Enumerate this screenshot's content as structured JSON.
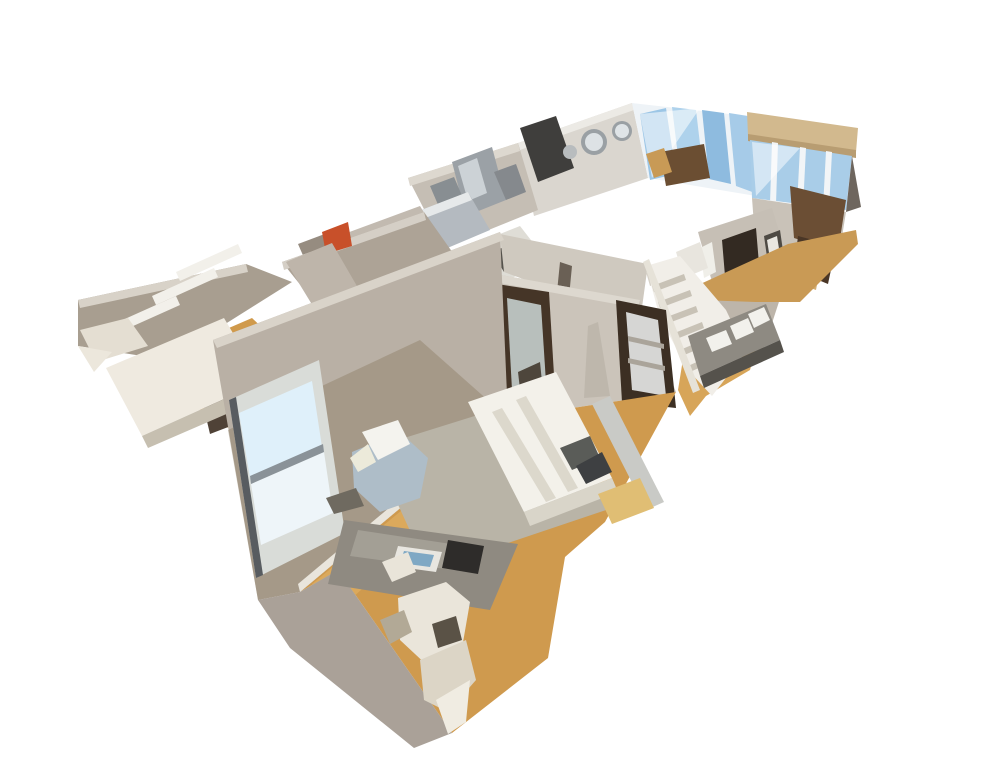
{
  "meta": {
    "description": "3D dollhouse cutaway view of an apartment interior scan, floating on a white background",
    "view": "dollhouse-orbit"
  },
  "canvas": {
    "width": 994,
    "height": 779,
    "background": "#ffffff"
  },
  "palette": {
    "wall_light": "#c8c1b6",
    "wall_mid": "#b9b0a5",
    "wall_dark": "#8f7f68",
    "wall_top_cut": "#ddd8cf",
    "floor_wood": "#cf9a4e",
    "floor_wood_light": "#dfae62",
    "rug": "#b9b4a7",
    "bed_white": "#f3f1ea",
    "window_blue": "#9cc6e6",
    "stainless": "#9ba1a6",
    "door_bronze": "#453527",
    "stair_white": "#f1eee8",
    "beam_tan": "#d2b98e",
    "accent_orange": "#c8502a"
  },
  "scene": {
    "shapes": [
      {
        "n": "far-wall-left",
        "f": "#dad6cf",
        "p": "518,143 632,103 648,178 534,216"
      },
      {
        "n": "far-wall-top-edge",
        "f": "#eceae5",
        "p": "518,143 632,103 634,110 520,150"
      },
      {
        "n": "far-window-frame",
        "f": "#eef3f7",
        "p": "632,103 747,116 756,196 648,178"
      },
      {
        "n": "far-window-pane-1",
        "f": "#9cc6e6",
        "p": "640,114 666,108 676,174 650,180"
      },
      {
        "n": "far-window-pane-2",
        "f": "#aed2ec",
        "p": "672,107 696,110 704,178 680,173"
      },
      {
        "n": "far-window-pane-3",
        "f": "#8ebbdf",
        "p": "702,110 724,113 731,184 709,179"
      },
      {
        "n": "far-window-pane-4",
        "f": "#a6cbe8",
        "p": "729,113 748,116 755,193 736,186"
      },
      {
        "n": "far-window-reflection",
        "f": "#ffffff",
        "o": 0.55,
        "p": "640,114 700,108 652,178"
      },
      {
        "n": "window-furniture-dark",
        "f": "#6b4e32",
        "p": "660,152 704,144 710,178 666,186"
      },
      {
        "n": "window-chair-tan",
        "f": "#c89a56",
        "p": "646,154 664,148 672,172 654,178"
      },
      {
        "n": "ceiling-beam",
        "f": "#d2b98e",
        "p": "747,112 858,128 856,152 748,136"
      },
      {
        "n": "ceiling-beam-edge",
        "f": "#b89d72",
        "p": "748,134 856,150 856,158 748,141"
      },
      {
        "n": "right-window-wall",
        "f": "#a9cde8",
        "p": "750,140 852,156 846,210 752,198"
      },
      {
        "n": "right-window-mullion-1",
        "f": "#f2f5f7",
        "p": "772,142 778,143 776,204 770,203"
      },
      {
        "n": "right-window-mullion-2",
        "f": "#f2f5f7",
        "p": "800,147 806,148 803,207 797,206"
      },
      {
        "n": "right-window-mullion-3",
        "f": "#f2f5f7",
        "p": "826,151 832,152 829,209 823,208"
      },
      {
        "n": "right-window-reflection",
        "f": "#ffffff",
        "o": 0.5,
        "p": "752,142 800,148 756,196"
      },
      {
        "n": "right-edge-shadow",
        "f": "#6e665e",
        "p": "852,156 861,207 846,212"
      },
      {
        "n": "far-right-lower-wall",
        "f": "#c9c2b8",
        "p": "752,198 846,212 838,262 756,252"
      },
      {
        "n": "kitchen-back-wall",
        "f": "#c5beb4",
        "p": "408,178 518,143 538,210 444,248"
      },
      {
        "n": "kitchen-wall-top-edge",
        "f": "#ddd8cf",
        "p": "408,178 518,143 520,151 410,186"
      },
      {
        "n": "kitchen-dark-fridge",
        "f": "#3f3e3c",
        "p": "520,128 556,116 574,168 538,182"
      },
      {
        "n": "kitchen-steel-fridge",
        "f": "#9ba1a6",
        "p": "452,162 492,147 506,200 466,216"
      },
      {
        "n": "kitchen-steel-highlight",
        "f": "#ccd2d6",
        "p": "458,166 477,158 487,193 468,201"
      },
      {
        "n": "kitchen-steel-unit-1",
        "f": "#888e92",
        "p": "430,186 454,177 463,198 439,207"
      },
      {
        "n": "kitchen-steel-unit-2",
        "f": "#85898d",
        "p": "494,172 516,164 526,192 506,200"
      },
      {
        "n": "kitchen-counter",
        "f": "#b4bac0",
        "p": "416,212 468,192 490,230 438,252"
      },
      {
        "n": "kitchen-counter-edge",
        "f": "#e6e9ea",
        "p": "416,212 468,192 472,200 420,220"
      },
      {
        "n": "kitchen-island",
        "f": "#dfddd6",
        "p": "470,246 520,226 548,262 498,284"
      },
      {
        "n": "kitchen-island-dark",
        "f": "#55524c",
        "p": "492,252 516,242 528,262 504,272"
      },
      {
        "n": "bath-wall-1",
        "f": "#c2bab0",
        "p": "344,234 420,206 452,258 376,288"
      },
      {
        "n": "bath-wall-2",
        "f": "#968c80",
        "p": "298,244 346,226 360,258 312,276"
      },
      {
        "n": "corridor-left-wall",
        "f": "#ada396",
        "p": "282,262 424,212 472,280 330,322"
      },
      {
        "n": "corridor-wall-top-edge",
        "f": "#d5cfc6",
        "p": "282,262 424,212 426,220 284,270"
      },
      {
        "n": "orange-towel",
        "f": "#c8502a",
        "p": "322,232 348,222 352,246 326,254"
      },
      {
        "n": "corridor-doorway",
        "f": "#6b6156",
        "p": "310,294 346,281 358,313 322,327"
      },
      {
        "n": "corridor-floor",
        "f": "#cc9a50",
        "p": "292,332 360,302 398,354 330,390"
      },
      {
        "n": "closet-back-wall",
        "f": "#a89e90",
        "p": "78,300 246,264 292,282 168,360 78,346"
      },
      {
        "n": "closet-wall-top-edge",
        "f": "#d8d2c8",
        "p": "78,300 246,264 248,272 80,308"
      },
      {
        "n": "closet-side-wall",
        "f": "#beb5aa",
        "p": "286,262 332,243 372,312 330,334"
      },
      {
        "n": "closet-hook-rail-1",
        "f": "#f2f0ea",
        "p": "152,296 214,268 218,277 156,305"
      },
      {
        "n": "closet-hook-rail-2",
        "f": "#f2f0ea",
        "p": "176,272 238,244 242,253 180,281"
      },
      {
        "n": "closet-hook-rail-3",
        "f": "#f2f0ea",
        "p": "118,322 176,296 180,305 122,331"
      },
      {
        "n": "closet-floor",
        "f": "#d09a4c",
        "p": "150,362 252,318 330,392 288,424 218,428"
      },
      {
        "n": "closet-stool-dark",
        "f": "#4f4237",
        "p": "202,400 226,392 236,424 210,434"
      },
      {
        "n": "closet-table-top",
        "f": "#efeae0",
        "p": "106,368 224,318 262,382 142,436"
      },
      {
        "n": "closet-table-edge",
        "f": "#c6bfb0",
        "p": "142,436 262,382 268,396 148,448"
      },
      {
        "n": "closet-table-support",
        "f": "#e4ded2",
        "p": "80,330 128,318 148,346 96,362"
      },
      {
        "n": "closet-table-tip",
        "f": "#ece7dc",
        "p": "78,346 112,352 94,372"
      },
      {
        "n": "hall-upper-wall",
        "f": "#cfc9bf",
        "p": "500,234 648,264 640,322 504,272"
      },
      {
        "n": "hall-door-frame-line",
        "f": "#6a6055",
        "p": "560,262 572,266 566,328 554,322"
      },
      {
        "n": "hall-wall-vent",
        "f": "#d8d3ca",
        "p": "646,272 664,266 668,280 650,286"
      },
      {
        "n": "entry-wall",
        "f": "#c6bfb5",
        "p": "698,232 772,208 790,268 716,296"
      },
      {
        "n": "entry-dark-doorway",
        "f": "#332a22",
        "p": "722,240 756,228 762,300 728,312"
      },
      {
        "n": "entry-doorway-floor",
        "f": "#c49a5c",
        "p": "734,288 754,280 758,302 738,310"
      },
      {
        "n": "entry-art-frame",
        "f": "#4e4a44",
        "p": "764,236 780,230 784,258 768,264"
      },
      {
        "n": "entry-art-mat",
        "f": "#e9e7e1",
        "p": "767,240 777,236 780,255 770,259"
      },
      {
        "n": "entry-towel-white",
        "f": "#f0efe9",
        "p": "700,248 712,242 716,272 704,278"
      },
      {
        "n": "entry-cabinet-white",
        "f": "#e8e5de",
        "p": "676,252 700,242 708,268 684,278"
      },
      {
        "n": "entry-wood-furniture-1",
        "f": "#6b4e34",
        "p": "790,186 846,200 838,252 794,238"
      },
      {
        "n": "entry-wood-furniture-2",
        "f": "#4a3626",
        "p": "798,236 836,246 828,284 794,270"
      },
      {
        "n": "entry-wood-tan",
        "f": "#d2ae74",
        "p": "793,252 822,258 816,290 788,280"
      },
      {
        "n": "entry-lower-wall",
        "f": "#bdb5aa",
        "p": "716,296 790,268 760,360 706,338"
      },
      {
        "n": "entry-floor",
        "f": "#c99a55",
        "p": "696,286 788,244 856,230 858,244 800,302 756,302 700,300"
      },
      {
        "n": "hall-floor",
        "f": "#d7a559",
        "p": "678,390 688,328 756,348 750,370 706,396 690,416"
      },
      {
        "n": "staircase-body",
        "f": "#f1eee8",
        "p": "646,266 680,256 726,310 746,352 712,396 688,370 660,318"
      },
      {
        "n": "stair-step-1",
        "f": "#c8c2b6",
        "p": "652,286 684,274 686,280 654,292"
      },
      {
        "n": "stair-step-2",
        "f": "#c8c2b6",
        "p": "658,302 690,290 692,296 660,308"
      },
      {
        "n": "stair-step-3",
        "f": "#c8c2b6",
        "p": "664,318 696,306 698,312 666,324"
      },
      {
        "n": "stair-step-4",
        "f": "#c8c2b6",
        "p": "672,334 702,322 704,328 674,340"
      },
      {
        "n": "stair-step-5",
        "f": "#c8c2b6",
        "p": "680,350 708,338 710,344 682,356"
      },
      {
        "n": "stair-step-6",
        "f": "#c8c2b6",
        "p": "688,366 714,354 716,360 690,372"
      },
      {
        "n": "stair-railing",
        "f": "#e6e2d8",
        "p": "643,262 649,259 700,390 693,393"
      },
      {
        "n": "hall-counter",
        "f": "#8e8a82",
        "p": "688,336 766,304 780,340 700,376"
      },
      {
        "n": "counter-paper-1",
        "f": "#f2f1ec",
        "p": "706,338 726,330 732,344 712,352"
      },
      {
        "n": "counter-paper-2",
        "f": "#f2f1ec",
        "p": "730,326 748,318 754,332 736,340"
      },
      {
        "n": "counter-paper-3",
        "f": "#f2f1ec",
        "p": "748,314 764,307 770,320 754,328"
      },
      {
        "n": "counter-dark-edge",
        "f": "#55524c",
        "p": "700,376 780,340 784,352 704,388"
      },
      {
        "n": "bedroom-cross-wall",
        "f": "#cbc4ba",
        "p": "462,268 640,300 676,392 508,418"
      },
      {
        "n": "cross-wall-top-edge",
        "f": "#ddd8cf",
        "p": "462,268 640,300 638,308 460,276"
      },
      {
        "n": "tripod-lamp-shadow",
        "f": "#b6afa4",
        "o": 0.6,
        "p": "588,326 598,322 610,396 584,398"
      },
      {
        "n": "mirror-door-frame",
        "f": "#453527",
        "p": "497,284 549,292 556,408 502,398"
      },
      {
        "n": "mirror-door-glass",
        "f": "#b8bfbc",
        "p": "507,298 541,305 547,398 512,390"
      },
      {
        "n": "mirror-door-reflection-dark",
        "f": "#4e463c",
        "p": "518,372 540,362 543,392 521,398"
      },
      {
        "n": "closet-door-frame",
        "f": "#3c2f23",
        "p": "616,300 666,310 676,408 622,402"
      },
      {
        "n": "closet-door-interior",
        "f": "#d6d6d4",
        "p": "626,312 658,320 666,396 632,390"
      },
      {
        "n": "closet-shelf-line-1",
        "f": "#aaa49a",
        "p": "628,336 664,344 664,349 628,341"
      },
      {
        "n": "closet-shelf-line-2",
        "f": "#aaa49a",
        "p": "628,358 665,366 665,371 628,363"
      },
      {
        "n": "bedroom-floor",
        "f": "#cf9a4e",
        "p": "300,592 508,418 676,392 605,522 565,557 548,658 452,733 338,570"
      },
      {
        "n": "bedroom-floor-light-band",
        "f": "#dfae62",
        "o": 0.75,
        "p": "312,584 502,428 540,430 352,598"
      },
      {
        "n": "bedroom-exterior-wall",
        "f": "#b9b0a5",
        "p": "213,340 500,232 508,418 300,592 258,600"
      },
      {
        "n": "exterior-wall-lower-shade",
        "f": "#8f7f66",
        "o": 0.45,
        "p": "228,430 420,340 508,418 300,592 258,600"
      },
      {
        "n": "exterior-wall-top-edge",
        "f": "#d9d3c9",
        "p": "213,340 500,232 504,240 217,348"
      },
      {
        "n": "bedroom-baseboard",
        "f": "#e9e5dc",
        "p": "298,584 506,410 508,418 300,592"
      },
      {
        "n": "window-frame",
        "f": "#d9dcd8",
        "p": "229,400 319,360 345,533 256,578"
      },
      {
        "n": "window-pane-top",
        "f": "#dff0fa",
        "p": "239,413 312,381 322,447 250,478"
      },
      {
        "n": "window-pane-bottom",
        "f": "#eef5f9",
        "p": "251,484 324,452 333,513 261,545"
      },
      {
        "n": "window-sash-bar",
        "f": "#8a9298",
        "p": "250,476 323,444 324,452 251,484"
      },
      {
        "n": "window-frame-dark-edge",
        "f": "#585c60",
        "p": "229,400 236,397 263,575 256,578"
      },
      {
        "n": "bedroom-end-wall",
        "f": "#aaa198",
        "p": "338,570 452,733 414,748 290,648 258,600 300,592"
      },
      {
        "n": "area-rug",
        "f": "#b9b4a7",
        "p": "372,448 558,390 612,508 428,570"
      },
      {
        "n": "bed-mattress",
        "f": "#f3f1ea",
        "p": "468,402 556,372 612,478 524,512"
      },
      {
        "n": "bed-seam-1",
        "f": "#dcd8cc",
        "p": "492,412 502,408 556,498 546,502"
      },
      {
        "n": "bed-seam-2",
        "f": "#dcd8cc",
        "p": "516,400 526,396 578,488 568,492"
      },
      {
        "n": "bed-foot-shadow",
        "f": "#d9d5c9",
        "p": "524,512 612,478 618,492 530,526"
      },
      {
        "n": "bed-pillow-1",
        "f": "#5a5c58",
        "p": "560,448 590,436 600,458 572,470"
      },
      {
        "n": "bed-pillow-2",
        "f": "#3e4042",
        "p": "576,466 602,452 612,472 586,484"
      },
      {
        "n": "headboard-tv-bar",
        "f": "#c9cac6",
        "p": "592,404 610,396 664,502 646,510"
      },
      {
        "n": "bedside-pouf-tan",
        "f": "#e0be74",
        "p": "598,494 640,478 654,508 612,524"
      },
      {
        "n": "armchair-gray",
        "f": "#aebdc8",
        "p": "352,452 400,432 428,458 420,498 380,512 354,488"
      },
      {
        "n": "armchair-throw-white",
        "f": "#f4f3ee",
        "p": "362,432 398,420 410,444 378,460"
      },
      {
        "n": "armchair-throw-fold",
        "f": "#eceada",
        "p": "350,458 368,444 376,462 358,472"
      },
      {
        "n": "floor-clutter-dark",
        "f": "#6f6a60",
        "p": "326,498 356,488 364,506 334,514"
      },
      {
        "n": "desk-top",
        "f": "#8f8a81",
        "p": "344,520 518,544 490,610 328,584"
      },
      {
        "n": "desk-top-highlight",
        "f": "#a8a49a",
        "o": 0.8,
        "p": "358,530 478,548 468,572 350,556"
      },
      {
        "n": "desk-book",
        "f": "#e8e6e0",
        "p": "398,546 442,552 436,572 392,566"
      },
      {
        "n": "desk-book-image",
        "f": "#7fa8c4",
        "p": "404,551 434,555 430,567 400,563"
      },
      {
        "n": "desk-black-object",
        "f": "#2e2c2a",
        "p": "448,540 484,546 478,574 442,568"
      },
      {
        "n": "desk-chair-arm",
        "f": "#e9e4d9",
        "p": "382,562 408,552 416,572 392,582"
      },
      {
        "n": "desk-chair-back",
        "f": "#eae5da",
        "p": "398,598 446,582 470,602 462,648 430,668 400,640"
      },
      {
        "n": "desk-chair-seat",
        "f": "#dcd5c6",
        "p": "420,660 466,640 476,680 448,712 424,700"
      },
      {
        "n": "desk-chair-base",
        "f": "#f0ece2",
        "p": "436,700 470,680 466,722 448,734"
      },
      {
        "n": "desk-chair-shadow",
        "f": "#b2a996",
        "p": "380,620 404,610 412,632 390,644"
      },
      {
        "n": "desk-chair-dark-gap",
        "f": "#5a5246",
        "p": "432,624 456,616 462,640 438,648"
      }
    ],
    "circles": [
      {
        "n": "wall-mirror-large-ring",
        "f": "#9aa0a4",
        "cx": 594,
        "cy": 142,
        "r": 13
      },
      {
        "n": "wall-mirror-large-glass",
        "f": "#dde2e5",
        "cx": 594,
        "cy": 142,
        "r": 9
      },
      {
        "n": "wall-mirror-small-ring",
        "f": "#9aa0a4",
        "cx": 622,
        "cy": 131,
        "r": 10
      },
      {
        "n": "wall-mirror-small-glass",
        "f": "#dfe4e7",
        "cx": 622,
        "cy": 131,
        "r": 7
      },
      {
        "n": "wall-mirror-third",
        "f": "#b8bcbe",
        "cx": 570,
        "cy": 152,
        "r": 7
      }
    ]
  }
}
